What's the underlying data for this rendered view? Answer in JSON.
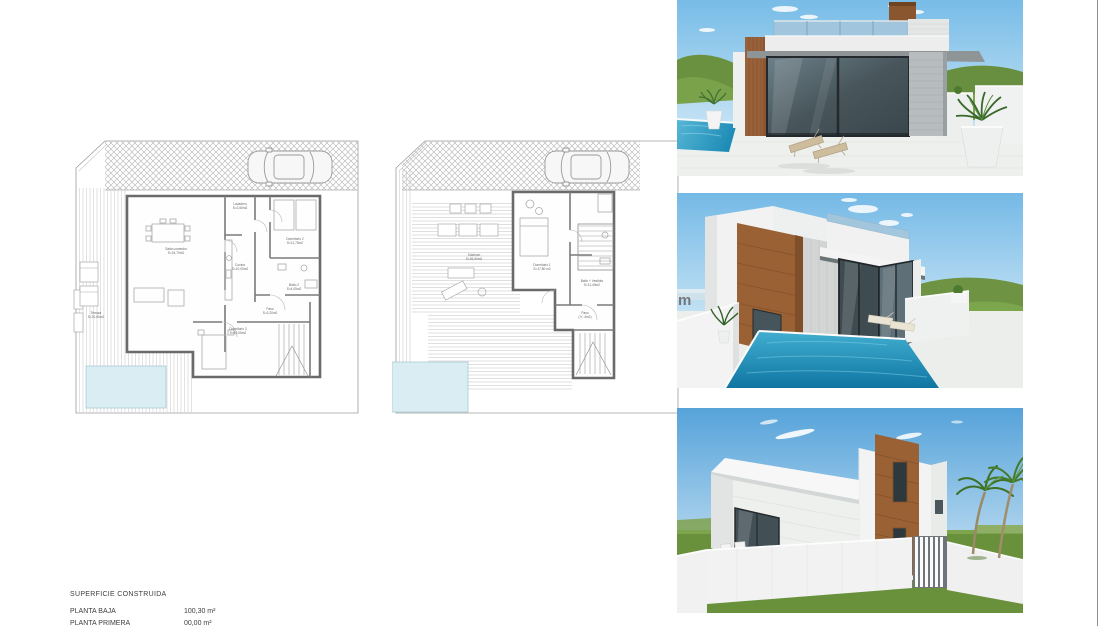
{
  "summary": {
    "title": "SUPERFICIE CONSTRUIDA",
    "rows": [
      {
        "label": "PLANTA BAJA",
        "value": "100,30 m²"
      },
      {
        "label": "PLANTA PRIMERA",
        "value": "00,00 m²"
      }
    ]
  },
  "plans": {
    "ground_floor": {
      "rooms": [
        {
          "label": "Lavadero",
          "area": "S=2,60m2"
        },
        {
          "label": "Salón-comedor",
          "area": "S=24,70m2"
        },
        {
          "label": "Cocina",
          "area": "S=10,00m2"
        },
        {
          "label": "Dormitorio 2",
          "area": "S=11,70m2"
        },
        {
          "label": "Baño 2",
          "area": "S=4,05m2"
        },
        {
          "label": "Paso",
          "area": "S=3,20m2"
        },
        {
          "label": "Dormitorio 3",
          "area": "S=10,05m2"
        },
        {
          "label": "Terraza",
          "area": "S=21,80m2"
        }
      ]
    },
    "first_floor": {
      "rooms": [
        {
          "label": "Solarium",
          "area": "S=45,60m2"
        },
        {
          "label": "Dormitorio 1",
          "area": "S=17,80 m2"
        },
        {
          "label": "Baño + Vestidor",
          "area": "S=11,40m2"
        },
        {
          "label": "Paso",
          "area": "(+/- 4m2)"
        }
      ]
    }
  },
  "renders": [
    {
      "name": "front pool view"
    },
    {
      "name": "corner pool view",
      "watermark_fragment": "m"
    },
    {
      "name": "street view"
    }
  ],
  "palette": {
    "sky": "#77bce7",
    "grass": "#6a9140",
    "pool_render": "#2d9cc6",
    "pool_plan": "#d9edf2",
    "wood": "#9a6234",
    "plan_wall": "#6a6a6a",
    "plan_line": "#9c9c9c",
    "page_edge": "#8c8c8c"
  }
}
